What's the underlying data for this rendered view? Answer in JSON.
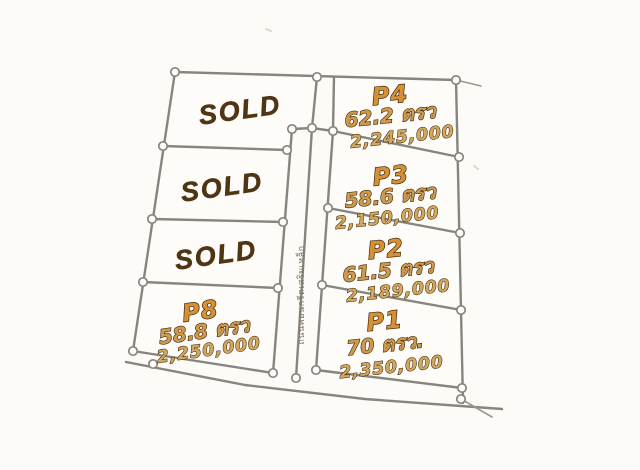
{
  "plots": {
    "left_column": [
      {
        "id": "sold-1",
        "status": "SOLD"
      },
      {
        "id": "sold-2",
        "status": "SOLD"
      },
      {
        "id": "sold-3",
        "status": "SOLD"
      },
      {
        "id": "p8",
        "label": "P8",
        "area": "58.8 ตรว",
        "price": "2,250,000"
      }
    ],
    "right_column": [
      {
        "id": "p4",
        "label": "P4",
        "area": "62.2 ตรว",
        "price": "2,245,000"
      },
      {
        "id": "p3",
        "label": "P3",
        "area": "58.6 ตรว",
        "price": "2,150,000"
      },
      {
        "id": "p2",
        "label": "P2",
        "area": "61.5 ตรว",
        "price": "2,189,000"
      },
      {
        "id": "p1",
        "label": "P1",
        "area": "70 ตรว.",
        "price": "2,350,000"
      }
    ]
  },
  "road": {
    "label": "ถนนคอนกรีตเสริมเหล็ก"
  },
  "colors": {
    "background": "#fcfbf8",
    "boundary_line": "#87857f",
    "sold_text": "#4f3514",
    "plot_text_fill": "#d69136",
    "plot_text_outline": "#40280a"
  }
}
